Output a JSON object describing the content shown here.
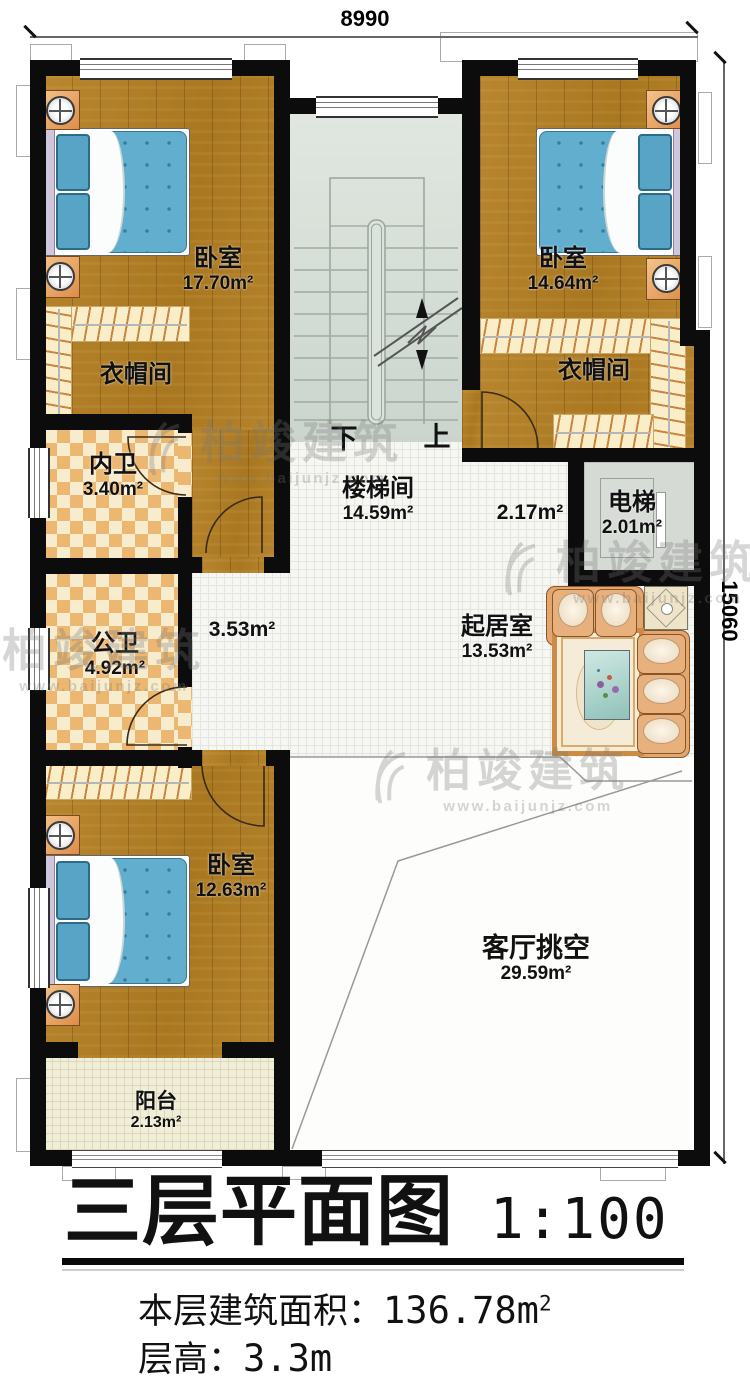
{
  "dimensions": {
    "top": "8990",
    "right": "15060"
  },
  "watermark": {
    "brand": "柏竣建筑",
    "url": "www.baijunjz.com"
  },
  "rooms": {
    "bedroom_tl": {
      "name": "卧室",
      "area": "17.70m²"
    },
    "bedroom_tr": {
      "name": "卧室",
      "area": "14.64m²"
    },
    "cloak_left": {
      "name": "衣帽间"
    },
    "cloak_right": {
      "name": "衣帽间"
    },
    "bath_inner": {
      "name": "内卫",
      "area": "3.40m²"
    },
    "bath_public": {
      "name": "公卫",
      "area": "4.92m²"
    },
    "stairwell": {
      "name": "楼梯间",
      "area": "14.59m²"
    },
    "elevator": {
      "name": "电梯",
      "area": "2.01m²"
    },
    "hall_left": {
      "area": "3.53m²"
    },
    "hall_right": {
      "area": "2.17m²"
    },
    "living": {
      "name": "起居室",
      "area": "13.53m²"
    },
    "bedroom_b": {
      "name": "卧室",
      "area": "12.63m²"
    },
    "void": {
      "name": "客厅挑空",
      "area": "29.59m²"
    },
    "balcony": {
      "name": "阳台",
      "area": "2.13m²"
    }
  },
  "stairs": {
    "down": "下",
    "up": "上"
  },
  "title": {
    "text": "三层平面图",
    "scale": "1:100"
  },
  "footer": {
    "area_label": "本层建筑面积：",
    "area_value": "136.78m",
    "area_sup": "2",
    "height_label": "层高：",
    "height_value": "3.3m"
  }
}
